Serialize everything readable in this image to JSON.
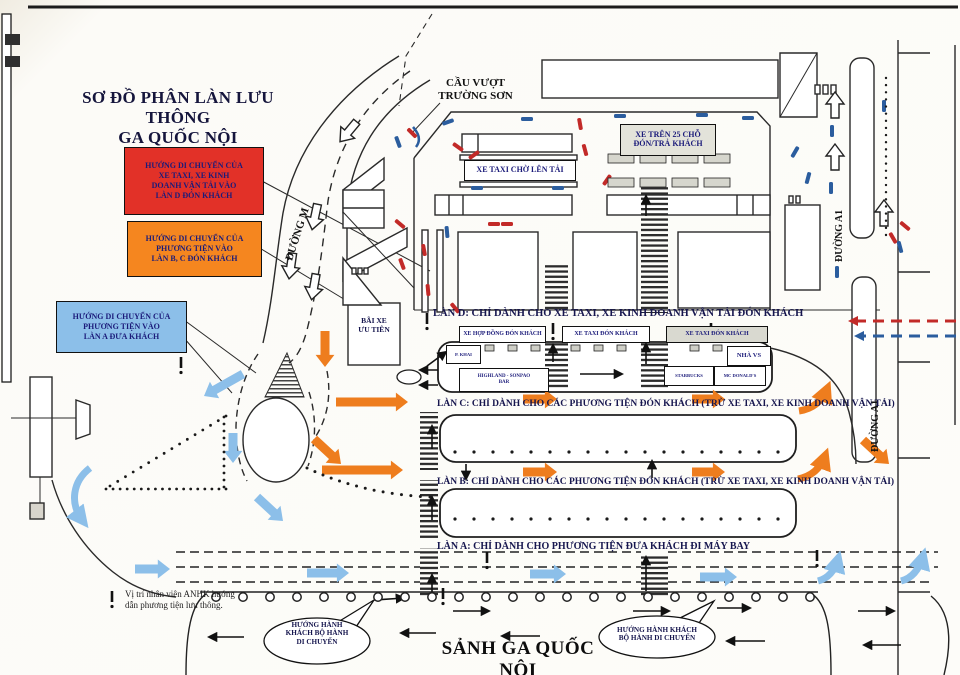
{
  "title": "SƠ ĐỒ PHÂN LÀN LƯU THÔNG\nGA QUỐC NỘI",
  "legend": {
    "red": {
      "color": "#e23128",
      "label": "HƯỚNG DI CHUYỂN CỦA\nXE TAXI, XE KINH\nDOANH VẬN TẢI VÀO\nLÀN D ĐÓN KHÁCH"
    },
    "orange": {
      "color": "#f5861f",
      "label": "HƯỚNG DI CHUYỂN CỦA\nPHƯƠNG TIỆN VÀO\nLÀN B, C ĐÓN KHÁCH"
    },
    "blue": {
      "color": "#8cbfe9",
      "label": "HƯỚNG DI CHUYỂN CỦA\nPHƯƠNG TIỆN VÀO\nLÀN A ĐƯA KHÁCH"
    }
  },
  "roads": {
    "overpass": "CẦU VƯỢT\nTRƯỜNG SƠN",
    "road_m": "ĐƯỜNG M",
    "road_a1_upper": "ĐƯỜNG A1",
    "road_a1_lower": "ĐƯỜNG A1"
  },
  "zones": {
    "bus25": "XE TRÊN 25 CHỖ\nĐÓN/TRẢ KHÁCH",
    "taxi_queue": "XE TAXI CHỜ LÊN TẢI",
    "priority_parking": "BÃI XE\nƯU TIÊN"
  },
  "lane_d_stops": {
    "contract": "XE HỢP ĐỒNG ĐÓN KHÁCH",
    "taxi_1": "XE TAXI ĐÓN KHÁCH",
    "taxi_2": "XE TAXI ĐÓN KHÁCH"
  },
  "median": {
    "kiosk": "P. KHAI",
    "cafe": "HIGHLAND - SONPAO\nBAR",
    "restroom": "NHÀ VS",
    "shop_left": "STARBUCKS",
    "shop_right": "MC DONALD'S"
  },
  "lanes": {
    "d": "LÀN D: CHỈ DÀNH CHO XE TAXI, XE KINH DOANH VẬN TẢI ĐÓN KHÁCH",
    "c": "LÀN C: CHỈ DÀNH CHO CÁC PHƯƠNG TIỆN ĐÓN KHÁCH (TRỪ XE TAXI, XE KINH DOANH VẬN TẢI)",
    "b": "LÀN B: CHỈ DÀNH CHO CÁC PHƯƠNG TIỆN ĐÓN KHÁCH (TRỪ XE TAXI, XE KINH DOANH VẬN TẢI)",
    "a": "LÀN A: CHỈ DÀNH CHO PHƯƠNG TIỆN ĐƯA KHÁCH ĐI MÁY BAY"
  },
  "terminal_hall": "SẢNH GA QUỐC NỘI",
  "callouts": {
    "left": "HƯỚNG HÀNH\nKHÁCH BỘ HÀNH\nDI CHUYỂN",
    "right": "HƯỚNG HÀNH KHÁCH\nBỘ HÀNH DI CHUYỂN"
  },
  "note": "Vị trí nhân viên ANHK hướng\ndẫn phương tiện lưu thông.",
  "palette": {
    "taxi_route": "#c22a28",
    "other_route": "#2b5d9e",
    "pickup_arrow": "#ee7d1e",
    "dropoff_arrow": "#8cbfe9"
  }
}
